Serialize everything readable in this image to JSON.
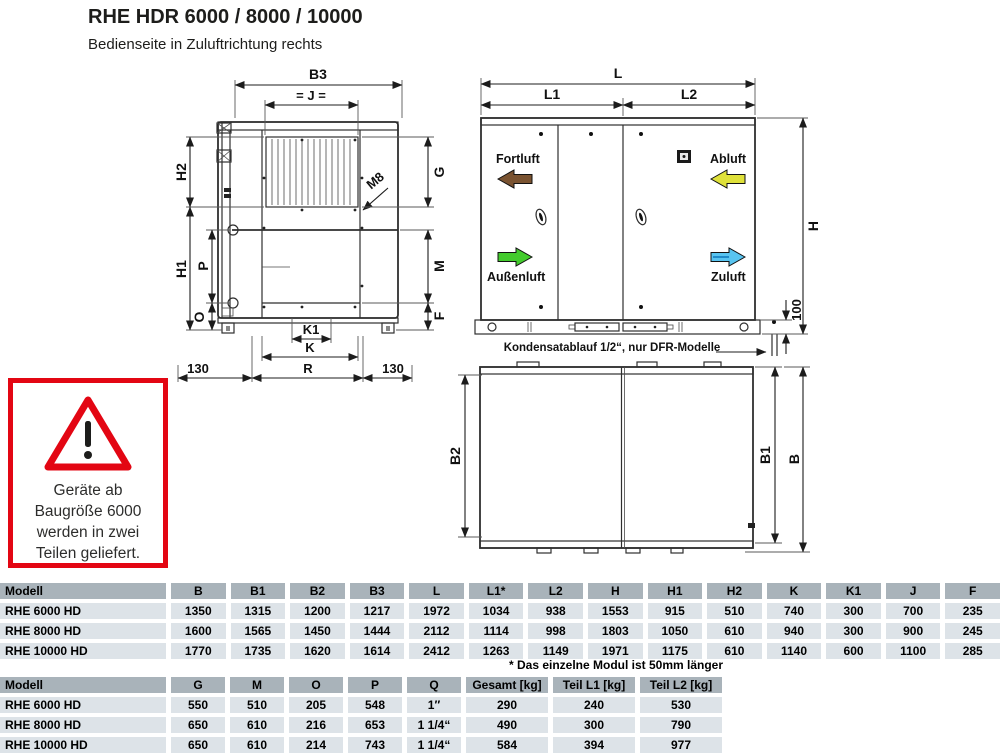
{
  "header": {
    "title": "RHE HDR 6000 / 8000 / 10000",
    "subtitle": "Bedienseite in Zuluftrichtung rechts"
  },
  "warning": {
    "lines": [
      "Geräte ab",
      "Baugröße 6000",
      "werden in zwei",
      "Teilen geliefert."
    ],
    "border_color": "#e30613"
  },
  "front_view": {
    "labels": {
      "b3": "B3",
      "j": "= J =",
      "m8": "M8",
      "h2": "H2",
      "h1": "H1",
      "p": "P",
      "o": "O",
      "g": "G",
      "m": "M",
      "f": "F",
      "k1": "K1",
      "k": "K",
      "r": "R",
      "left_offset": "130",
      "right_offset": "130"
    }
  },
  "side_view": {
    "labels": {
      "l": "L",
      "l1": "L1",
      "l2": "L2",
      "h": "H",
      "base_height": "100"
    },
    "flows": {
      "fortluft": {
        "label": "Fortluft",
        "color": "#7a5331",
        "direction": "left"
      },
      "abluft": {
        "label": "Abluft",
        "color": "#dfe13a",
        "direction": "left"
      },
      "aussenluft": {
        "label": "Außenluft",
        "color": "#43cb2d",
        "direction": "right"
      },
      "zuluft": {
        "label": "Zuluft",
        "color": "#58c4f0",
        "direction": "right"
      }
    },
    "note": "Kondensatablauf 1/2“, nur DFR-Modelle"
  },
  "top_view": {
    "labels": {
      "b2": "B2",
      "b1": "B1",
      "b": "B"
    }
  },
  "table1": {
    "columns": [
      "Modell",
      "B",
      "B1",
      "B2",
      "B3",
      "L",
      "L1*",
      "L2",
      "H",
      "H1",
      "H2",
      "K",
      "K1",
      "J",
      "F"
    ],
    "rows": [
      [
        "RHE 6000 HD",
        "1350",
        "1315",
        "1200",
        "1217",
        "1972",
        "1034",
        "938",
        "1553",
        "915",
        "510",
        "740",
        "300",
        "700",
        "235"
      ],
      [
        "RHE 8000 HD",
        "1600",
        "1565",
        "1450",
        "1444",
        "2112",
        "1114",
        "998",
        "1803",
        "1050",
        "610",
        "940",
        "300",
        "900",
        "245"
      ],
      [
        "RHE 10000 HD",
        "1770",
        "1735",
        "1620",
        "1614",
        "2412",
        "1263",
        "1149",
        "1971",
        "1175",
        "610",
        "1140",
        "600",
        "1100",
        "285"
      ]
    ],
    "footnote": "* Das einzelne Modul ist 50mm länger"
  },
  "table2": {
    "columns": [
      "Modell",
      "G",
      "M",
      "O",
      "P",
      "Q",
      "Gesamt [kg]",
      "Teil L1 [kg]",
      "Teil L2 [kg]"
    ],
    "rows": [
      [
        "RHE 6000 HD",
        "550",
        "510",
        "205",
        "548",
        "1″",
        "290",
        "240",
        "530"
      ],
      [
        "RHE 8000 HD",
        "650",
        "610",
        "216",
        "653",
        "1 1/4“",
        "490",
        "300",
        "790"
      ],
      [
        "RHE 10000 HD",
        "650",
        "610",
        "214",
        "743",
        "1 1/4“",
        "584",
        "394",
        "977"
      ]
    ]
  }
}
